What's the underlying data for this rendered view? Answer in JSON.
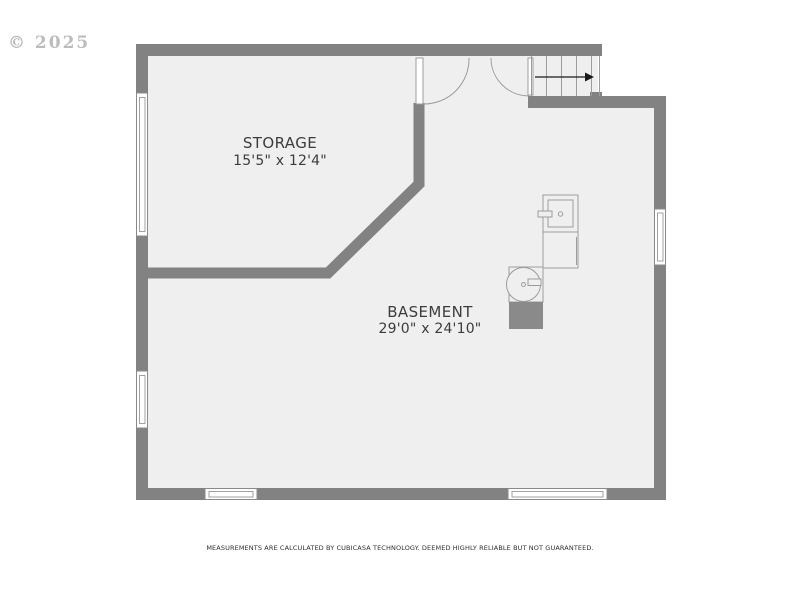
{
  "watermark": "© 2025",
  "rooms": [
    {
      "name": "STORAGE",
      "dimensions": "15'5\" x 12'4\""
    },
    {
      "name": "BASEMENT",
      "dimensions": "29'0\" x 24'10\""
    }
  ],
  "footer": "MEASUREMENTS ARE CALCULATED BY CUBICASA TECHNOLOGY. DEEMED HIGHLY RELIABLE BUT NOT GUARANTEED.",
  "colors": {
    "outside": "#ffffff",
    "floor": "#f0eff0",
    "wall": "#828282",
    "window-stroke": "#8a8a8a",
    "fixture-stroke": "#9c9c9c",
    "gray-box": "#8a8a8a",
    "label": "#3c3c3c",
    "watermark": "#bcbcbc",
    "arrow": "#1a1a1a"
  }
}
